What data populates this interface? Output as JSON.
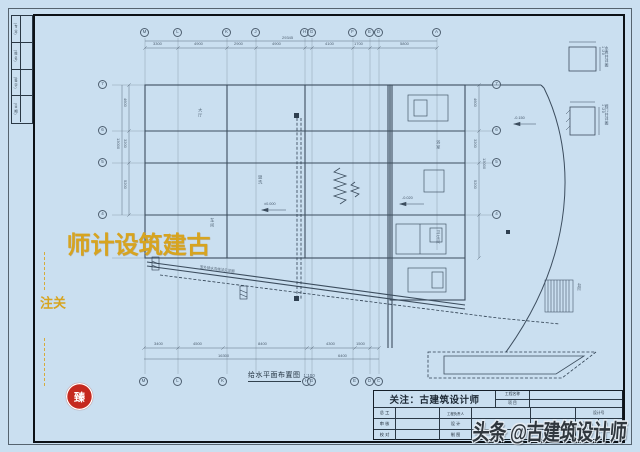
{
  "colors": {
    "paper_blue": "#cadff0",
    "ink": "#3c4d5e",
    "gold": "#d7a41f",
    "seal_red": "#c5291f",
    "watermark_ink": "#2f363d"
  },
  "binding_strip": {
    "rows": [
      "(专 业)",
      "(姓 名)",
      "(签 字)",
      "(日 期)"
    ]
  },
  "plan": {
    "title": "给水平面布置图",
    "scale": "1:100",
    "axes_top": [
      "M",
      "L",
      "K",
      "J",
      "H",
      "G",
      "F",
      "E",
      "D",
      "A"
    ],
    "axes_bottom": [
      "M",
      "L",
      "K",
      "H",
      "G",
      "E",
      "D",
      "C"
    ],
    "axes_left": [
      "7",
      "6",
      "5",
      "4"
    ],
    "axes_right": [
      "7",
      "6",
      "5",
      "4"
    ],
    "dims_top": [
      "3300",
      "4900",
      "2900",
      "4900",
      "4100",
      "1700",
      "5800"
    ],
    "dims_top_total": "29345",
    "dims_bottom": [
      "3400",
      "4500",
      "8400",
      "4300",
      "1500"
    ],
    "dims_bottom_totals": [
      "16300",
      "6400"
    ],
    "dims_left": [
      "4600",
      "3200",
      "5200"
    ],
    "dims_left_total": "13000",
    "dims_right": [
      "4600",
      "3200",
      "5200"
    ],
    "dims_right_total": "13000",
    "rooms": [
      "大厅",
      "车间",
      "盥洗",
      "浴室",
      "卫生间"
    ],
    "annotations": {
      "level_a": "±0.000",
      "level_b": "-0.020",
      "level_c": "-0.150",
      "drain_note": "室外排水沟做法见详图",
      "stair": "台阶"
    },
    "details": [
      {
        "label": "水表井详图",
        "scale": "1:20"
      },
      {
        "label": "阀门井详图",
        "scale": "1:20"
      }
    ]
  },
  "title_block": {
    "attention": "关注：古建筑设计师",
    "fields": {
      "chief": "总  工",
      "review": "审  核",
      "proof": "校  对",
      "lead": "工程负责人",
      "design": "设  计",
      "draft": "制  图",
      "project_name": "工程名称",
      "item": "项  目",
      "design_no": "设计号",
      "drawing_no": "图  号",
      "scale_label": "比  例"
    }
  },
  "watermarks": {
    "left_main": "古建筑设计师",
    "left_side": "关注",
    "seal": "臻",
    "bottom_right": "头条 @古建筑设计师"
  }
}
